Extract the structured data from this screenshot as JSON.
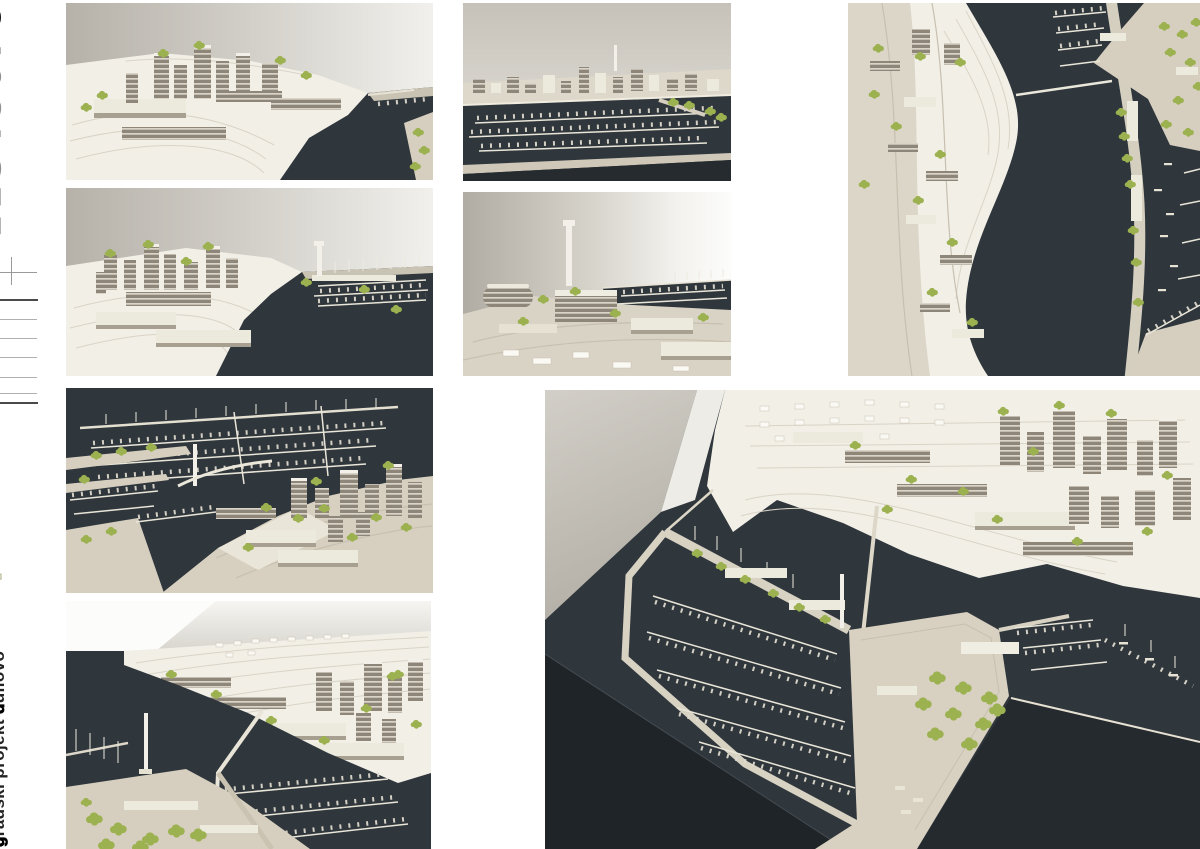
{
  "palette": {
    "accent-olive": "#b3b189",
    "water": "#2f363c",
    "table": "#1f2428",
    "paper": "#f2efe7",
    "board": "#d6cfbf",
    "building": "#8e8779",
    "building-stripe": "#d9d4c7",
    "tree": "#9cb14f",
    "pier": "#e9e6d9"
  },
  "sidebar": {
    "page_numbers": [
      "1",
      "2",
      "3",
      "4",
      "5",
      "6",
      "7",
      "8"
    ],
    "active_page": "8",
    "scale_marks": 7,
    "logo_parts": [
      {
        "text": "s",
        "style": "solid"
      },
      {
        "text": "pli",
        "style": "outline"
      },
      {
        "text": "t",
        "style": "solid"
      },
      {
        "text": " za ",
        "style": "outline"
      },
      {
        "text": "5",
        "style": "solid"
      }
    ],
    "project_line_small": "idejno urbanističko rješenje",
    "project_line_parts": [
      {
        "text": "g",
        "style": "bold"
      },
      {
        "text": "radski projekt ",
        "style": "normal"
      },
      {
        "text": "d",
        "style": "bold"
      },
      {
        "text": "uilovo",
        "style": "normal"
      }
    ]
  },
  "photos": [
    {
      "label": "model photo – towers above the channel, marina at right"
    },
    {
      "label": "model photo – hillside towers, marina basin and signal tower"
    },
    {
      "label": "model photo – frontal view across marina piers and city strip"
    },
    {
      "label": "model photo – buildings and signal tower with marina behind"
    },
    {
      "label": "model photo – aerial marina, bridge, pylon and tower cluster"
    },
    {
      "label": "model photo – contoured hillside district and marina below"
    },
    {
      "label": "model photo – top view of coast, channel and marina road"
    },
    {
      "label": "model photo – overview of marina basin, piers and hillside"
    }
  ]
}
